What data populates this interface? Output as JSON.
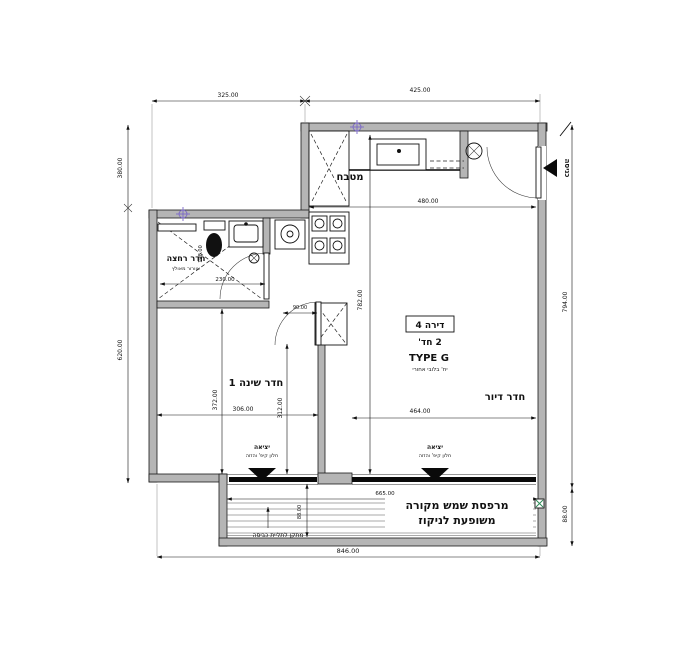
{
  "colors": {
    "wall": "#b5b5b5",
    "survey_marker": "#7b68c8",
    "drain": "#2e8b57"
  },
  "plan": {
    "unit": {
      "number_label": "דירה 4",
      "rooms_count": "2 חד'",
      "type": "TYPE G",
      "note": "יח' בלובי אחורי"
    },
    "rooms": {
      "kitchen": "מטבח",
      "bathroom": "חדר רחצה",
      "bathroom_note": "אוורור מאולץ",
      "bedroom": "חדר שינה 1",
      "living_room": "חדר דיור",
      "balcony_line1": "מרפסת שמש מקורה",
      "balcony_line2": "משופעת לניקוז"
    },
    "annotations": {
      "entrance": "כניסה",
      "exit": "יציאה",
      "exit_note": "חלון קיפ' והזזה",
      "laundry": "מתקן לתליית כביסה"
    },
    "dimensions": {
      "top_left": "325.00",
      "top_right": "425.00",
      "left_upper": "380.00",
      "left_lower": "620.00",
      "right_full": "794.00",
      "right_balcony": "88.00",
      "bottom_total": "846.00",
      "kitchen_width": "480.00",
      "interior_height": "782.00",
      "living_width": "464.00",
      "bedroom_width": "306.00",
      "bedroom_height": "372.00",
      "bedroom_inner_height": "312.00",
      "bathroom_width": "230.00",
      "bathroom_depth": "198.00",
      "shaft_width": "90.00",
      "balcony_width": "665.00",
      "balcony_depth": "88.00"
    }
  }
}
